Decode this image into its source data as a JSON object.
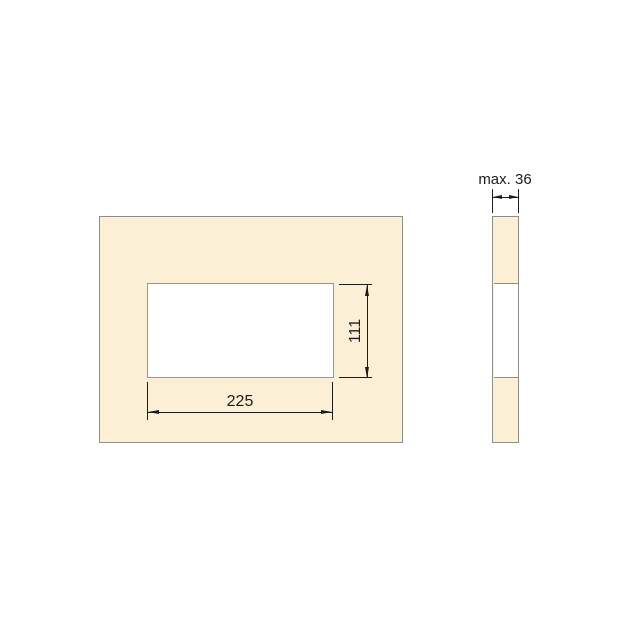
{
  "drawing": {
    "front_view": {
      "cutout_width_label": "225",
      "cutout_height_label": "111"
    },
    "side_view": {
      "max_thickness_label": "max. 36"
    },
    "colors": {
      "background": "#ffffff",
      "panel_fill": "#fbf0d5",
      "panel_border": "#8f8f88",
      "cutout_fill": "#ffffff",
      "dimension_lines": "#1c1c1c"
    }
  }
}
